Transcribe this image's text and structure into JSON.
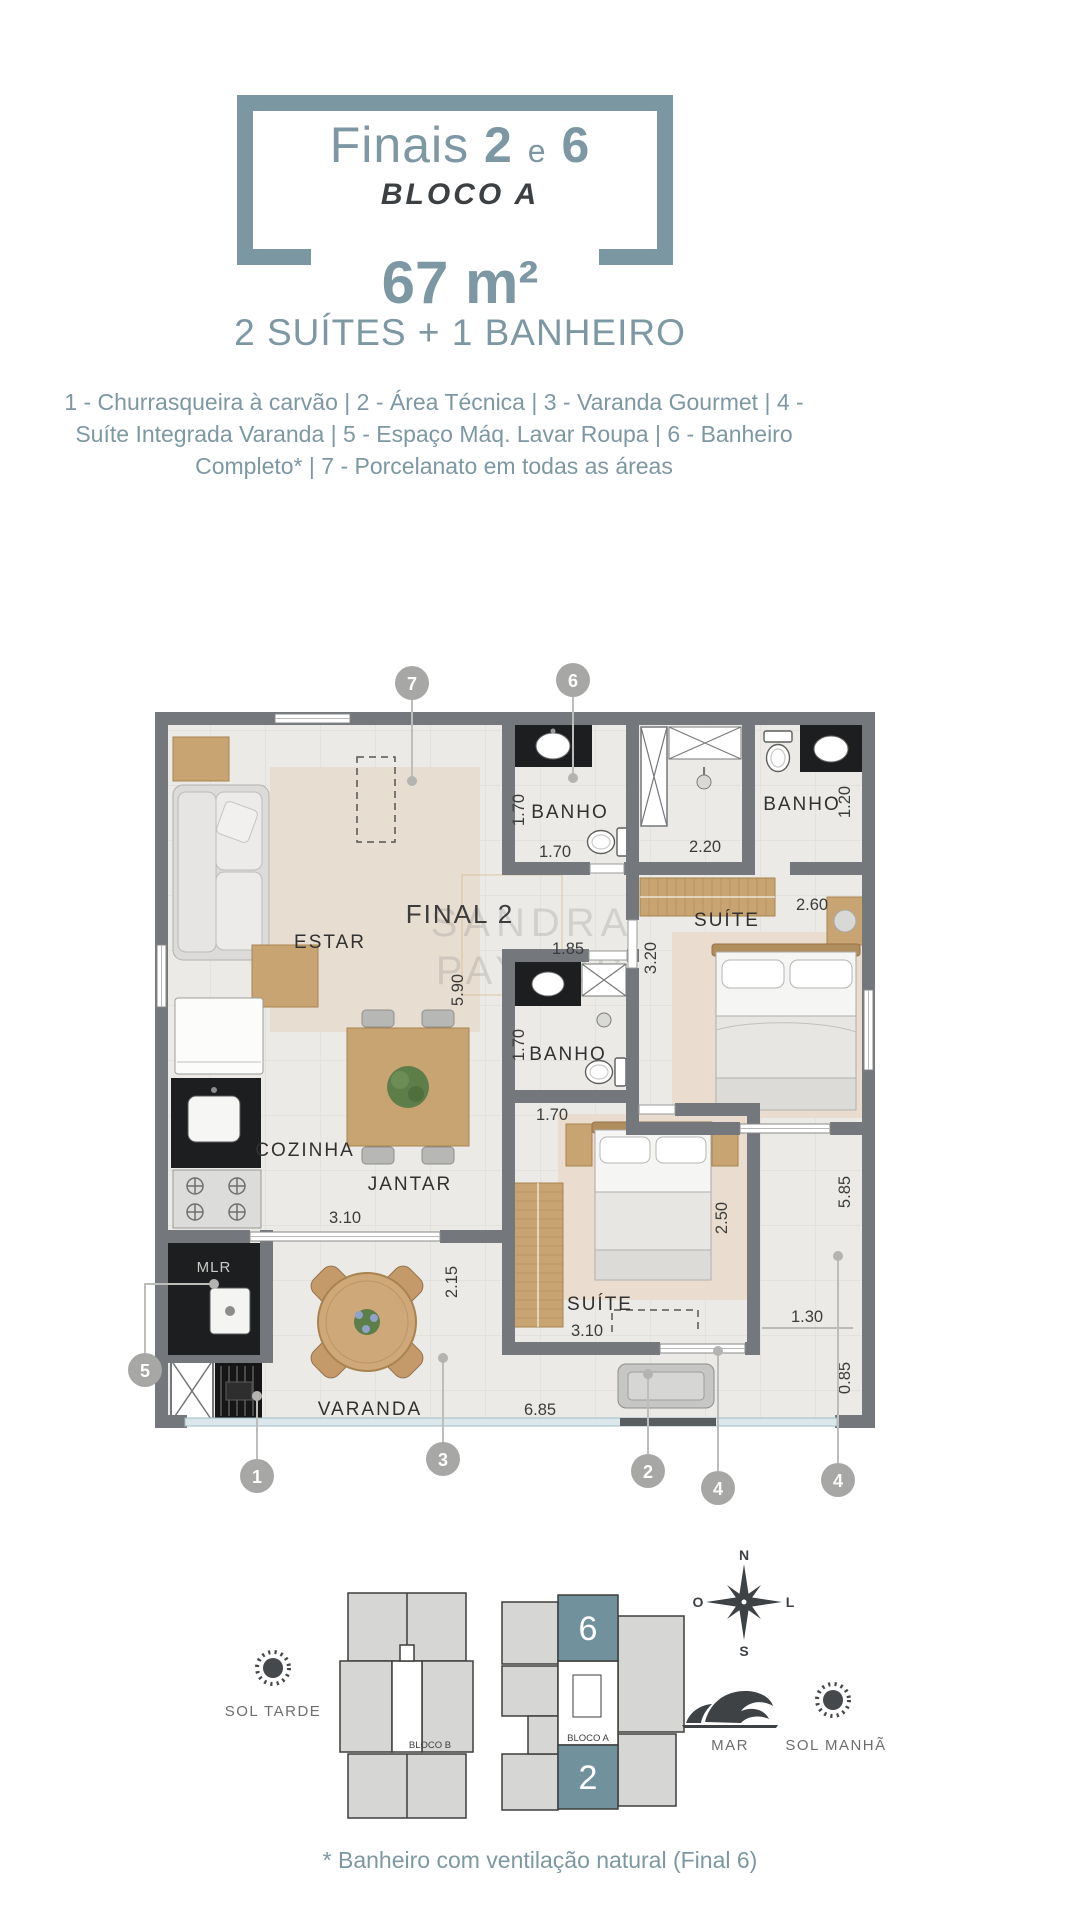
{
  "header": {
    "title": {
      "prefix": "Finais",
      "num_left": "2",
      "conjunction": "e",
      "num_right": "6"
    },
    "block": "BLOCO A",
    "area": "67 m²",
    "configuration": "2 SUÍTES + 1 BANHEIRO",
    "features": "1 - Churrasqueira à carvão  |  2 - Área Técnica  |  3 - Varanda Gourmet  |  4 - Suíte Integrada Varanda  |  5 - Espaço Máq. Lavar Roupa | 6 - Banheiro Completo*  |  7 - Porcelanato em todas as áreas"
  },
  "plan": {
    "unit_label": "FINAL 2",
    "labels": {
      "estar": "ESTAR",
      "cozinha": "COZINHA",
      "jantar": "JANTAR",
      "varanda": "VARANDA",
      "mlr": "MLR",
      "banho": "BANHO",
      "suite": "SUÍTE"
    },
    "dims": {
      "d170": "1.70",
      "d185": "1.85",
      "d590": "5.90",
      "d220": "2.20",
      "d120": "1.20",
      "d260": "2.60",
      "d320": "3.20",
      "d310": "3.10",
      "d215": "2.15",
      "d250": "2.50",
      "d585": "5.85",
      "d130": "1.30",
      "d085": "0.85",
      "d685": "6.85"
    },
    "markers": [
      "7",
      "6",
      "5",
      "1",
      "3",
      "2",
      "4",
      "4"
    ],
    "watermark": {
      "line1": "SANDRA",
      "line2": "PAYZOS"
    }
  },
  "keyplan": {
    "bloco_a": "BLOCO A",
    "bloco_b": "BLOCO B",
    "unit_top": "6",
    "unit_bottom": "2",
    "sun_afternoon": "SOL TARDE",
    "sea": "MAR",
    "sun_morning": "SOL MANHÃ",
    "compass": {
      "n": "N",
      "s": "S",
      "o": "O",
      "l": "L"
    }
  },
  "footnote": "* Banheiro com ventilação natural (Final 6)",
  "colors": {
    "accent": "#7d98a2",
    "wall": "#74777b",
    "keyplan_highlight": "#71929d",
    "marker": "#a7a7a5",
    "wood": "#c9a473"
  }
}
